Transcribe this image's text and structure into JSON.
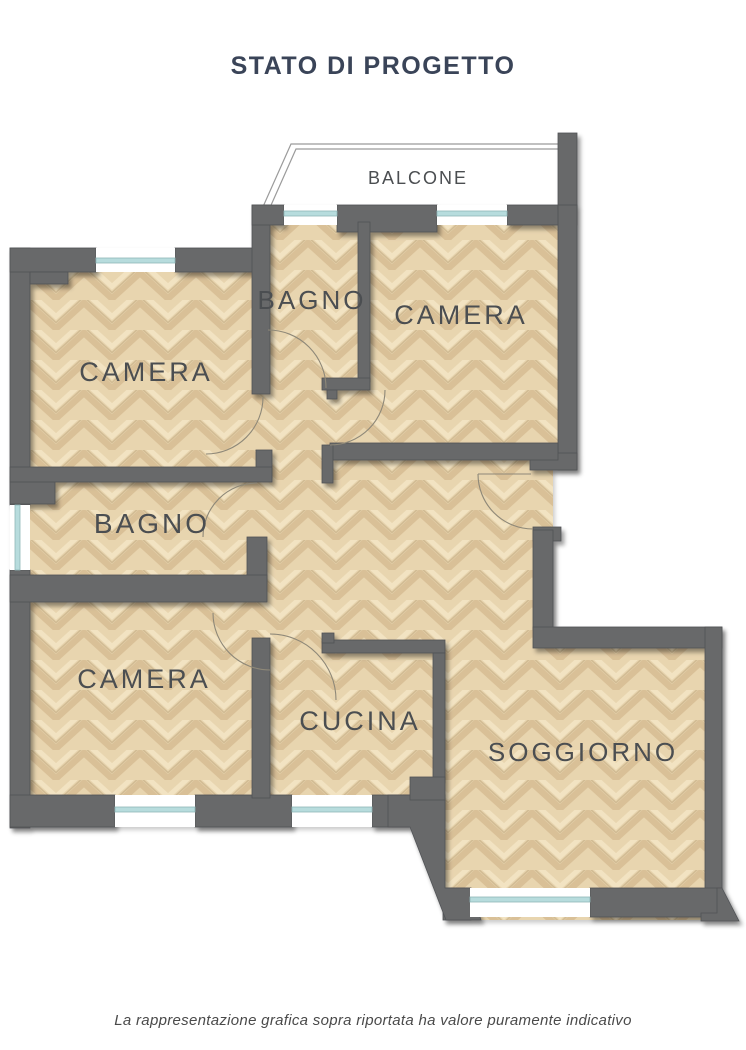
{
  "title": "STATO DI PROGETTO",
  "plan": {
    "balcone": "BALCONE",
    "camera_top_left": "CAMERA",
    "bagno_top": "BAGNO",
    "camera_top_right": "CAMERA",
    "bagno_middle": "BAGNO",
    "camera_bottom_left": "CAMERA",
    "cucina": "CUCINA",
    "soggiorno": "SOGGIORNO"
  },
  "disclaimer": "La rappresentazione grafica sopra riportata ha valore puramente indicativo",
  "colors": {
    "title": "#3a4458",
    "label": "#4b4e51",
    "wall": "#67696b",
    "wall_edge": "#515356",
    "floor_base": "#e8d5af",
    "floor_dark": "#c9ac80",
    "floor_mid": "#b99d74",
    "floor_light": "#f3e5c6",
    "window_glass": "#b7dcdd",
    "window_frame": "#8fb7b8",
    "railing": "#9b9b9b",
    "door_arc": "#8e8878"
  }
}
